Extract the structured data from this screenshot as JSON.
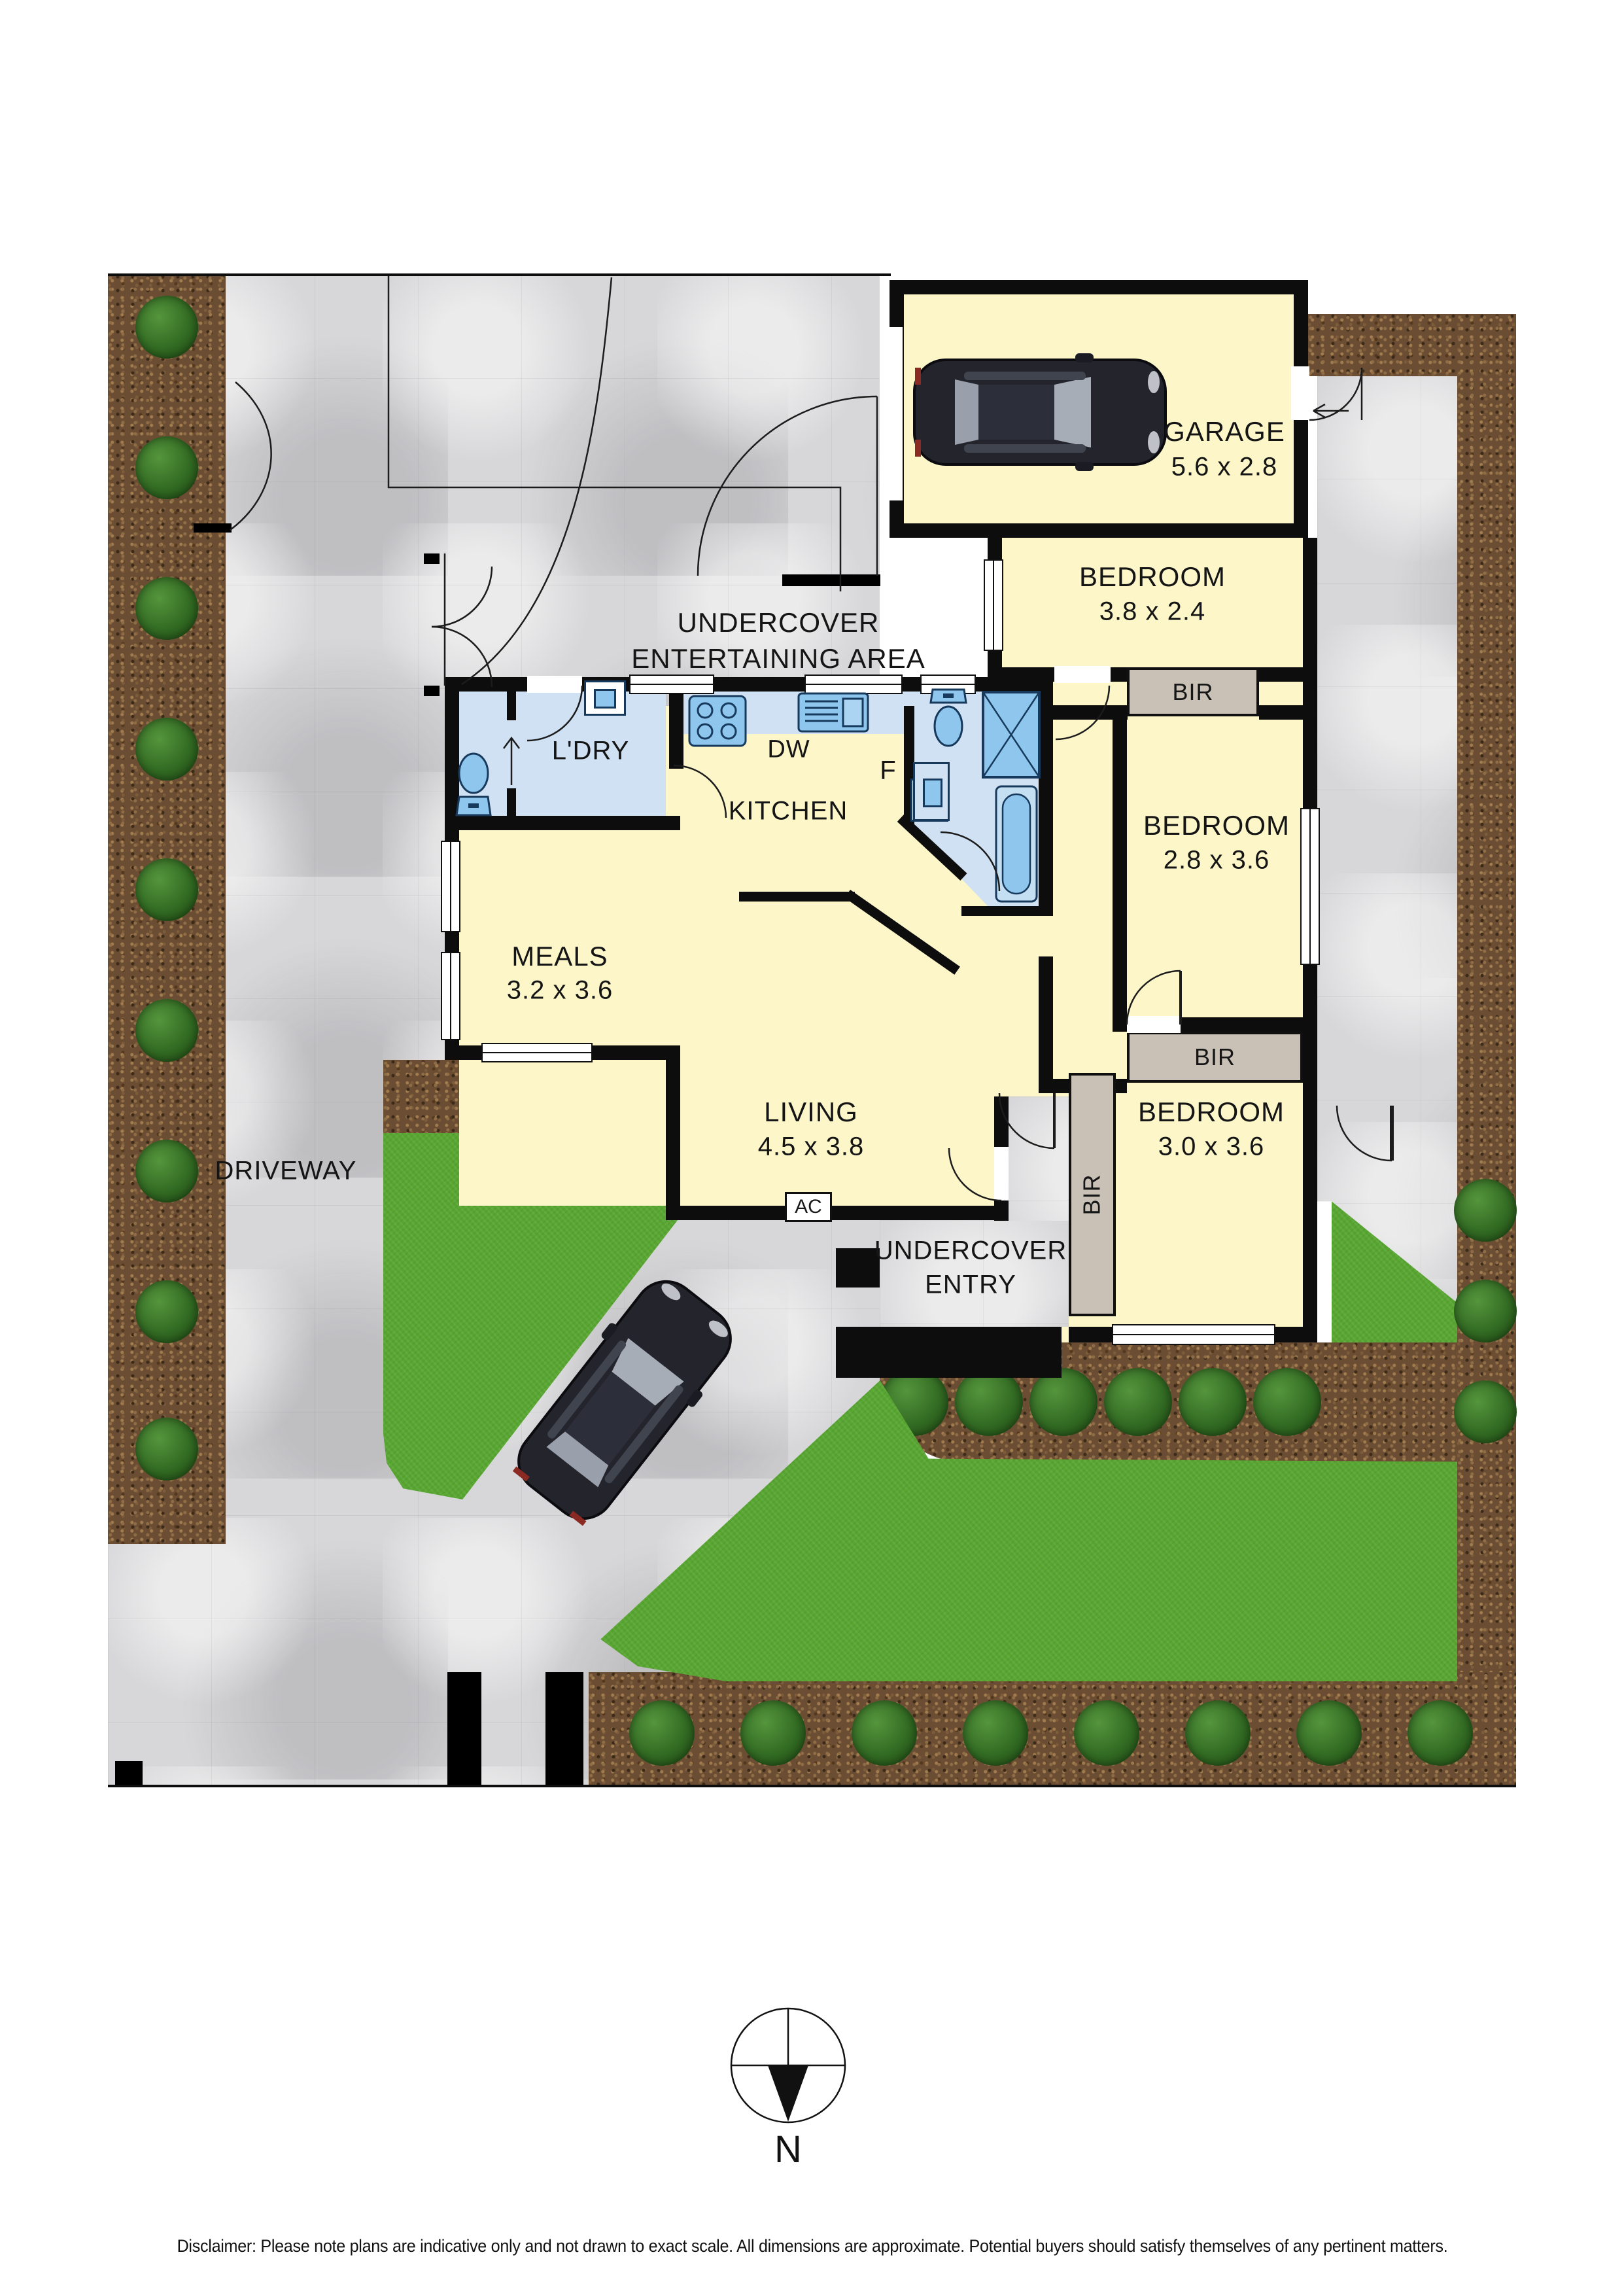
{
  "site": {
    "driveway": "DRIVEWAY",
    "entertaining_line1": "UNDERCOVER",
    "entertaining_line2": "ENTERTAINING AREA",
    "entry_line1": "UNDERCOVER",
    "entry_line2": "ENTRY",
    "north": "N",
    "disclaimer": "Disclaimer: Please note plans are indicative only and not drawn to exact scale. All dimensions are approximate. Potential buyers should satisfy themselves of any pertinent matters."
  },
  "rooms": {
    "garage": {
      "name": "GARAGE",
      "dims": "5.6 x 2.8"
    },
    "bedroom1": {
      "name": "BEDROOM",
      "dims": "3.8 x 2.4"
    },
    "bedroom2": {
      "name": "BEDROOM",
      "dims": "2.8 x 3.6"
    },
    "bedroom3": {
      "name": "BEDROOM",
      "dims": "3.0 x 3.6"
    },
    "meals": {
      "name": "MEALS",
      "dims": "3.2 x 3.6"
    },
    "living": {
      "name": "LIVING",
      "dims": "4.5 x 3.8"
    },
    "kitchen": {
      "name": "KITCHEN"
    },
    "laundry": {
      "name": "L'DRY"
    }
  },
  "fixtures": {
    "dishwasher": "DW",
    "fridge": "F",
    "air_conditioner": "AC",
    "built_in_robe": "BIR"
  },
  "colors": {
    "room_fill": "#fcf6c9",
    "wet_fill": "#cfe1f3",
    "fixture_blue": "#8ec6ee",
    "wall": "#0d0d0d",
    "robe_fill": "#c9c1b6",
    "lawn": "#58a631",
    "mulch": "#6b4d33",
    "concrete": "#d7d7d9"
  }
}
